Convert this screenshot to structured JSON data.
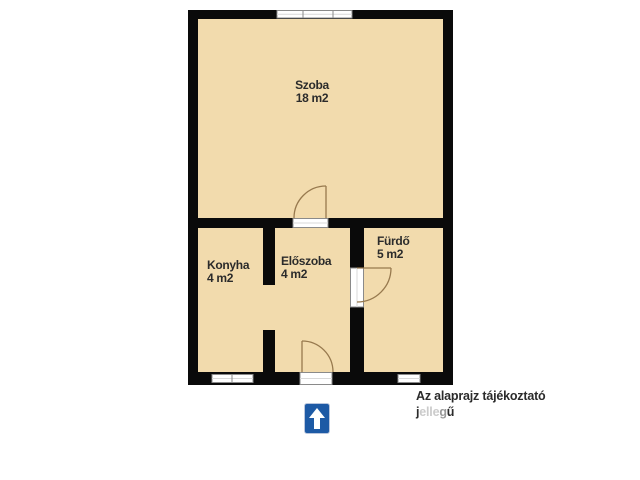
{
  "plan": {
    "title": "alaprajz",
    "rooms": [
      {
        "id": "szoba",
        "name": "Szoba",
        "area": "18 m2"
      },
      {
        "id": "konyha",
        "name": "Konyha",
        "area": "4 m2"
      },
      {
        "id": "eloszoba",
        "name": "Előszoba",
        "area": "4 m2"
      },
      {
        "id": "furdo",
        "name": "Fürdő",
        "area": "5 m2"
      }
    ],
    "symbols": {
      "windows": [
        "window-top",
        "window-bottom-left",
        "window-bottom-right"
      ],
      "doors": [
        "door-szoba-eloszoba",
        "door-eloszoba-furdo",
        "entrance-door"
      ],
      "open_passage": "konyha-eloszoba-opening"
    },
    "colors": {
      "wall": "#0a0a0a",
      "floor": "#f2dbad",
      "door_arc": "#97794e",
      "window_line": "#8a8a8a",
      "window_inner": "#d9d9d9"
    }
  },
  "north_sign": {
    "icon": "up-arrow-icon",
    "color": "#1d5aa5",
    "arrow_color": "#ffffff"
  },
  "annotation": {
    "line1": "Az alaprajz tájékoztató",
    "line2": "jellegű",
    "line2_parts": [
      {
        "text": "j",
        "style": "dark"
      },
      {
        "text": "elle",
        "style": "faded"
      },
      {
        "text": "g",
        "style": "semi"
      },
      {
        "text": "ű",
        "style": "dark"
      }
    ]
  }
}
